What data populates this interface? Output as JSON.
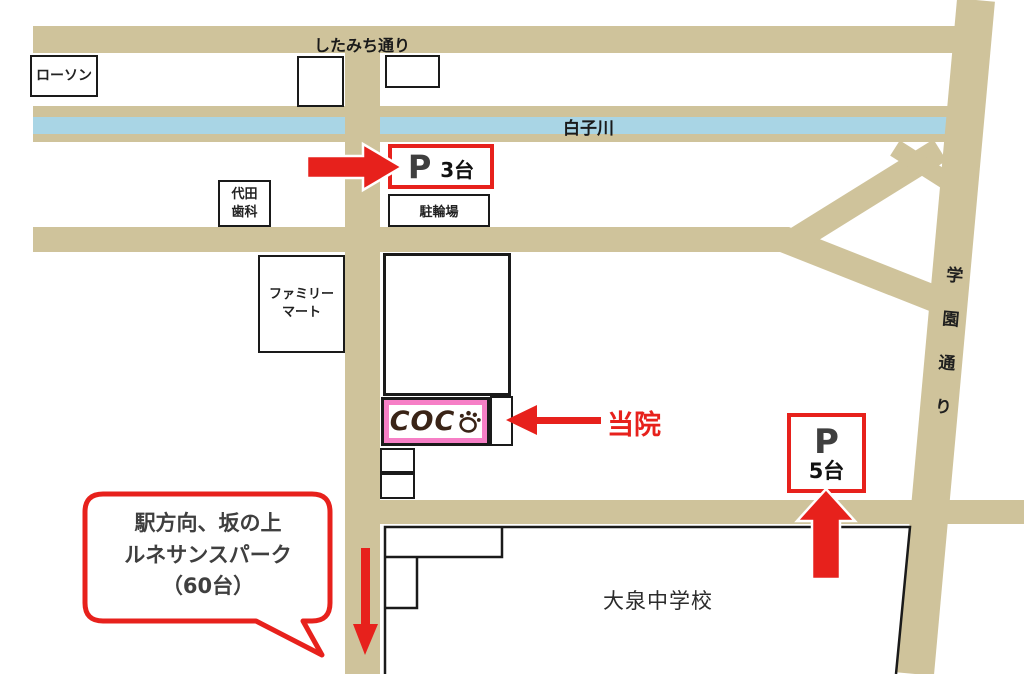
{
  "map": {
    "streets": {
      "shitamichi": "したみち通り",
      "gakuen_dori": "学園通り",
      "river": "白子川"
    },
    "places": {
      "lawson": "ローソン",
      "daita_dental_line1": "代田",
      "daita_dental_line2": "歯科",
      "familymart_line1": "ファミリー",
      "familymart_line2": "マート",
      "bike_parking": "駐輪場",
      "school": "大泉中学校",
      "clinic_name": "COC",
      "clinic_callout": "当院"
    },
    "parking": {
      "p3": {
        "symbol": "P",
        "capacity": "3台"
      },
      "p5": {
        "symbol": "P",
        "capacity": "5台"
      }
    },
    "bubble": {
      "line1": "駅方向、坂の上",
      "line2": "ルネサンスパーク",
      "line3": "（60台）"
    },
    "colors": {
      "road": "#cfc39b",
      "river": "#a9d5e5",
      "accent_red": "#e7211c",
      "clinic_pink": "#f67fc6",
      "parking_letter_gray": "#3f3f3f"
    }
  }
}
